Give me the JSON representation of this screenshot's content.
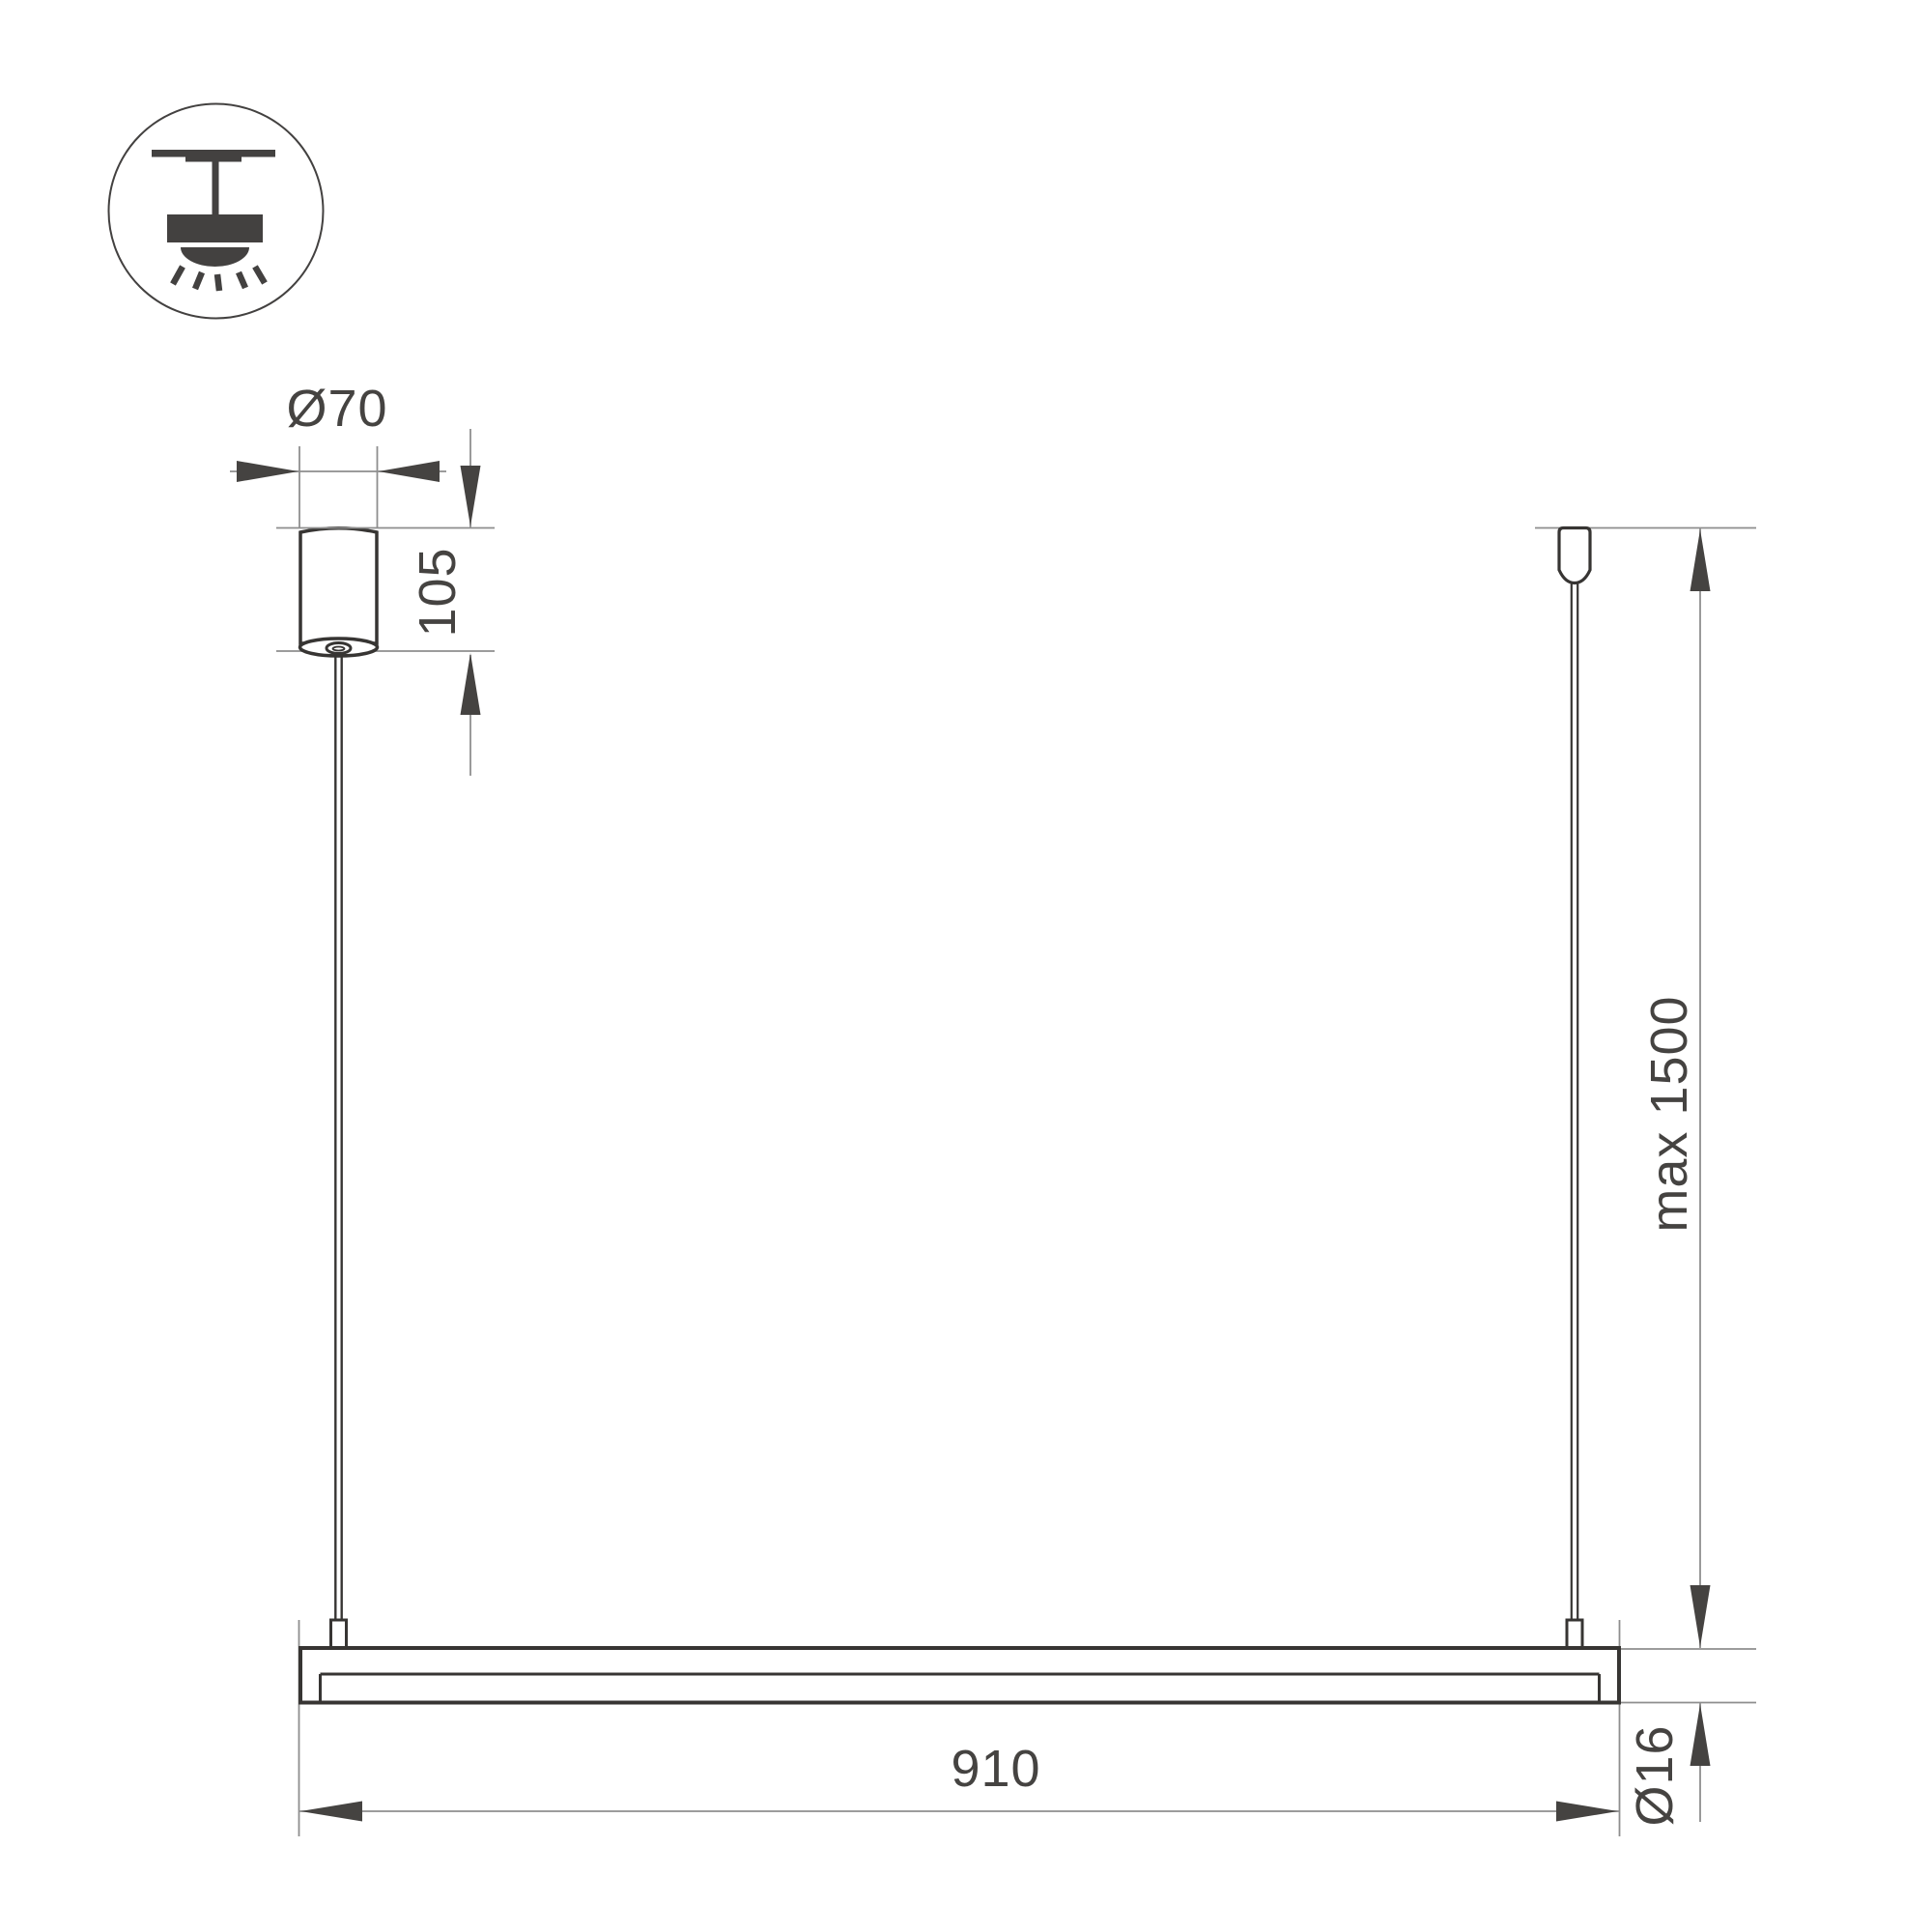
{
  "drawing": {
    "kind": "linear-pendant-luminaire-dimension-drawing"
  },
  "icon": {
    "name": "pendant-ceiling-light-icon"
  },
  "dimensions": {
    "canopy_diameter": "Ø70",
    "canopy_height": "105",
    "max_suspension": "max 1500",
    "fixture_length": "910",
    "tube_diameter": "Ø16"
  },
  "colors": {
    "background": "#ffffff",
    "outline": "#373533",
    "dimension_line": "#8e8e8e",
    "arrow_and_text": "#454341",
    "icon": "#434140"
  }
}
